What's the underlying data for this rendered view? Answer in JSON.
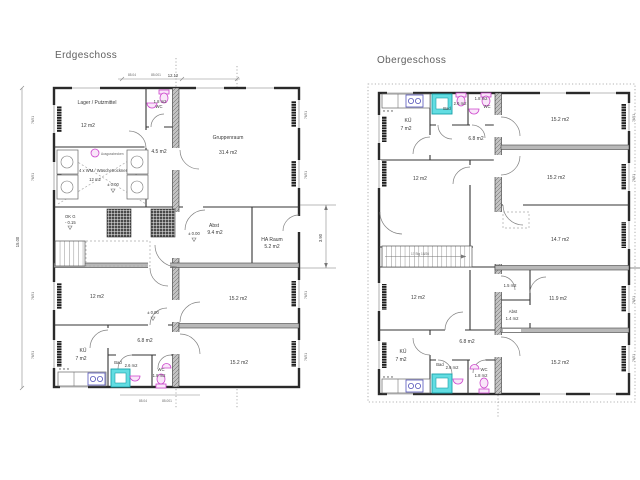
{
  "eg": {
    "title": "Erdgeschoss",
    "rooms": {
      "lager_name": "Lager / Putzmittel",
      "lager_area": "12 m2",
      "wc_top_area": "1.8 m2",
      "wc_top_name": "WC",
      "flur_top": "4.5 m2",
      "gruppenraum_name": "Gruppenraum",
      "gruppenraum_area": "31.4 m2",
      "wasch_name": "4 x WM / Wäschetrockner",
      "wasch_area": "12 m2",
      "ausguss": "Ausgussbecken",
      "ok_g1": "OK G",
      "ok_g2": "- 0.15",
      "abst_name": "Abst",
      "abst_area": "9.4 m2",
      "ha_name": "HA Raum",
      "ha_area": "5.2 m2",
      "zimmer_mitte_links": "12 m2",
      "zimmer_mitte_rechts": "15.2 m2",
      "flur_unten": "6.8 m2",
      "kueche_name": "KÜ",
      "kueche_area": "7 m2",
      "bad_name": "Bad",
      "bad_area": "2.6 m2",
      "wc_unten_name": "WC",
      "wc_unten_area": "1.8 m2",
      "zimmer_unten_rechts": "15.2 m2",
      "level_zero": "± 0.00"
    },
    "dims": {
      "top_a": "85.04",
      "top_b": "85.001",
      "top_total": "12.12",
      "left_total": "15.00",
      "right_height": "3.90",
      "bottom_a": "85.04",
      "bottom_b": "85.001"
    }
  },
  "og": {
    "title": "Obergeschoss",
    "rooms": {
      "kueche_oben_name": "KÜ",
      "kueche_oben_area": "7 m2",
      "bad_oben_name": "Bad",
      "bad_oben_area": "2.6 m2",
      "wc_oben_area": "1.8 m2",
      "wc_oben_name": "WC",
      "flur_oben": "6.8 m2",
      "zimmer_r1": "15.2 m2",
      "zimmer_r2": "15.2 m2",
      "zimmer_l1": "12 m2",
      "zimmer_r3": "14.7 m2",
      "treppe": "17 Stg 18/26",
      "zimmer_l2": "12 m2",
      "klein": "1.5 m2",
      "abst_name": "Abst",
      "abst_area": "1.4 m2",
      "zimmer_r4": "11.9 m2",
      "flur_unten": "6.8 m2",
      "kueche_unten_name": "KÜ",
      "kueche_unten_area": "7 m2",
      "bad_unten_name": "Bad",
      "bad_unten_area": "2.6 m2",
      "wc_unten_name": "WC",
      "wc_unten_area": "1.8 m2",
      "zimmer_r5": "15.2 m2"
    }
  },
  "annotations": {
    "window_mark": "76/51"
  },
  "colors": {
    "fixture_magenta": "#cc44cc",
    "shower_cyan": "#62dde2",
    "appliance_blue": "#5555bb",
    "wall_gray": "#b8b8b8"
  }
}
